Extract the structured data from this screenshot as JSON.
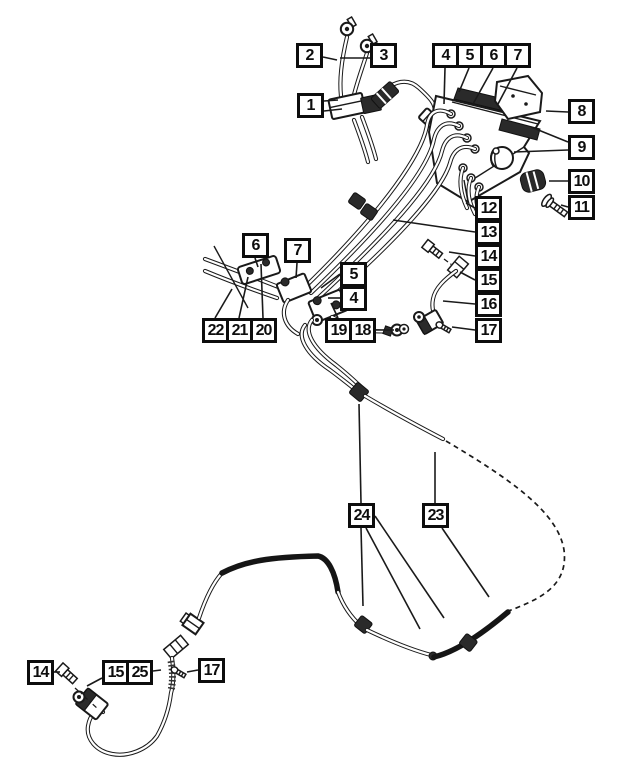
{
  "figure": {
    "type": "exploded-parts-diagram",
    "subject": "brake-tubes-and-hoses-with-hydraulic-control-unit",
    "callout_count": 29,
    "part_numbers_shown": [
      1,
      2,
      3,
      4,
      5,
      6,
      7,
      8,
      9,
      10,
      11,
      12,
      13,
      14,
      15,
      16,
      17,
      18,
      19,
      20,
      21,
      22,
      23,
      24,
      25
    ]
  },
  "colors": {
    "background": "#ffffff",
    "line": "#1a1a1a",
    "box_border": "#0d0d0d",
    "box_fill": "#ffffff",
    "dark_part": "#2a2a2a"
  },
  "icons": [
    "banjo-eyelet-icon",
    "hex-bolt-icon",
    "screw-icon",
    "grommet-icon",
    "tube-clip-icon",
    "tube-fitting-icon",
    "hose-spring-guard-icon"
  ],
  "callouts": [
    {
      "label": "1",
      "x": 297,
      "y": 93
    },
    {
      "label": "2",
      "x": 296,
      "y": 43
    },
    {
      "label": "3",
      "x": 370,
      "y": 43
    },
    {
      "label": "4",
      "x": 432,
      "y": 43
    },
    {
      "label": "5",
      "x": 456,
      "y": 43
    },
    {
      "label": "6",
      "x": 480,
      "y": 43
    },
    {
      "label": "7",
      "x": 504,
      "y": 43
    },
    {
      "label": "8",
      "x": 568,
      "y": 99
    },
    {
      "label": "9",
      "x": 568,
      "y": 135
    },
    {
      "label": "10",
      "x": 568,
      "y": 169
    },
    {
      "label": "11",
      "x": 568,
      "y": 195
    },
    {
      "label": "12",
      "x": 475,
      "y": 196
    },
    {
      "label": "13",
      "x": 475,
      "y": 220
    },
    {
      "label": "14",
      "x": 475,
      "y": 244
    },
    {
      "label": "15",
      "x": 475,
      "y": 268
    },
    {
      "label": "16",
      "x": 475,
      "y": 292
    },
    {
      "label": "17",
      "x": 475,
      "y": 318
    },
    {
      "label": "6",
      "x": 242,
      "y": 233
    },
    {
      "label": "7",
      "x": 284,
      "y": 238
    },
    {
      "label": "5",
      "x": 340,
      "y": 262
    },
    {
      "label": "4",
      "x": 340,
      "y": 286
    },
    {
      "label": "22",
      "x": 202,
      "y": 318
    },
    {
      "label": "21",
      "x": 226,
      "y": 318
    },
    {
      "label": "20",
      "x": 250,
      "y": 318
    },
    {
      "label": "19",
      "x": 325,
      "y": 318
    },
    {
      "label": "18",
      "x": 349,
      "y": 318
    },
    {
      "label": "24",
      "x": 348,
      "y": 503
    },
    {
      "label": "23",
      "x": 422,
      "y": 503
    },
    {
      "label": "14",
      "x": 27,
      "y": 660
    },
    {
      "label": "15",
      "x": 102,
      "y": 660
    },
    {
      "label": "25",
      "x": 126,
      "y": 660
    },
    {
      "label": "17",
      "x": 198,
      "y": 658
    }
  ],
  "leaders": [
    {
      "x1": 324,
      "y1": 101,
      "x2": 338,
      "y2": 100
    },
    {
      "x1": 324,
      "y1": 111,
      "x2": 342,
      "y2": 109
    },
    {
      "x1": 323,
      "y1": 57,
      "x2": 337,
      "y2": 60
    },
    {
      "x1": 370,
      "y1": 58,
      "x2": 340,
      "y2": 58
    },
    {
      "x1": 445,
      "y1": 68,
      "x2": 444,
      "y2": 104
    },
    {
      "x1": 469,
      "y1": 68,
      "x2": 459,
      "y2": 92
    },
    {
      "x1": 493,
      "y1": 68,
      "x2": 473,
      "y2": 104
    },
    {
      "x1": 517,
      "y1": 68,
      "x2": 498,
      "y2": 104
    },
    {
      "x1": 568,
      "y1": 112,
      "x2": 546,
      "y2": 111
    },
    {
      "x1": 568,
      "y1": 142,
      "x2": 531,
      "y2": 127
    },
    {
      "x1": 568,
      "y1": 150,
      "x2": 514,
      "y2": 152
    },
    {
      "x1": 568,
      "y1": 181,
      "x2": 549,
      "y2": 181
    },
    {
      "x1": 568,
      "y1": 207,
      "x2": 561,
      "y2": 205
    },
    {
      "x1": 475,
      "y1": 208,
      "x2": 466,
      "y2": 203
    },
    {
      "x1": 475,
      "y1": 232,
      "x2": 393,
      "y2": 220
    },
    {
      "x1": 475,
      "y1": 256,
      "x2": 449,
      "y2": 252
    },
    {
      "x1": 475,
      "y1": 280,
      "x2": 460,
      "y2": 272
    },
    {
      "x1": 475,
      "y1": 304,
      "x2": 443,
      "y2": 301
    },
    {
      "x1": 475,
      "y1": 330,
      "x2": 452,
      "y2": 327
    },
    {
      "x1": 255,
      "y1": 258,
      "x2": 258,
      "y2": 267
    },
    {
      "x1": 297,
      "y1": 263,
      "x2": 296,
      "y2": 278
    },
    {
      "x1": 340,
      "y1": 274,
      "x2": 321,
      "y2": 288
    },
    {
      "x1": 340,
      "y1": 298,
      "x2": 328,
      "y2": 298
    },
    {
      "x1": 215,
      "y1": 318,
      "x2": 232,
      "y2": 289
    },
    {
      "x1": 239,
      "y1": 318,
      "x2": 248,
      "y2": 277
    },
    {
      "x1": 263,
      "y1": 318,
      "x2": 261,
      "y2": 264
    },
    {
      "x1": 338,
      "y1": 318,
      "x2": 331,
      "y2": 303
    },
    {
      "x1": 376,
      "y1": 330,
      "x2": 394,
      "y2": 330
    },
    {
      "x1": 361,
      "y1": 503,
      "x2": 359,
      "y2": 404
    },
    {
      "x1": 361,
      "y1": 528,
      "x2": 363,
      "y2": 606
    },
    {
      "x1": 366,
      "y1": 528,
      "x2": 420,
      "y2": 629
    },
    {
      "x1": 375,
      "y1": 516,
      "x2": 444,
      "y2": 618
    },
    {
      "x1": 435,
      "y1": 503,
      "x2": 435,
      "y2": 452
    },
    {
      "x1": 442,
      "y1": 528,
      "x2": 489,
      "y2": 597
    },
    {
      "x1": 54,
      "y1": 672,
      "x2": 60,
      "y2": 672
    },
    {
      "x1": 102,
      "y1": 678,
      "x2": 87,
      "y2": 686
    },
    {
      "x1": 153,
      "y1": 671,
      "x2": 161,
      "y2": 670
    },
    {
      "x1": 198,
      "y1": 670,
      "x2": 187,
      "y2": 672
    }
  ]
}
